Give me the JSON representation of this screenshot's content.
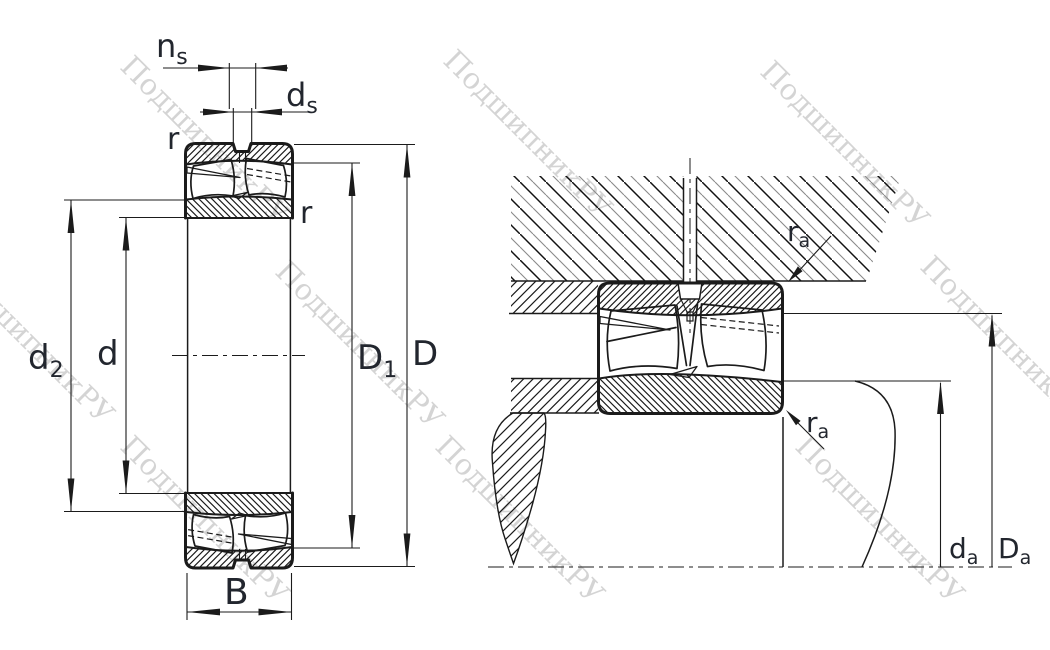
{
  "drawing_title": "spherical-roller-bearing-dimension-drawing",
  "watermark": {
    "text": "ПодшипникРУ"
  },
  "labels": {
    "ns": {
      "main": "n",
      "sub": "s"
    },
    "ds": {
      "main": "d",
      "sub": "s"
    },
    "r_top": "r",
    "r_right": "r",
    "d2": {
      "main": "d",
      "sub": "2"
    },
    "d": "d",
    "D1": {
      "main": "D",
      "sub": "1"
    },
    "D": "D",
    "B": "B",
    "ra_top": {
      "main": "r",
      "sub": "a"
    },
    "ra_bottom": {
      "main": "r",
      "sub": "a"
    },
    "da": {
      "main": "d",
      "sub": "a"
    },
    "Da": {
      "main": "D",
      "sub": "a"
    }
  },
  "colors": {
    "line": "#1b1b1b",
    "label": "#22262e",
    "watermark": "#b2b2b2",
    "background": "#ffffff"
  }
}
